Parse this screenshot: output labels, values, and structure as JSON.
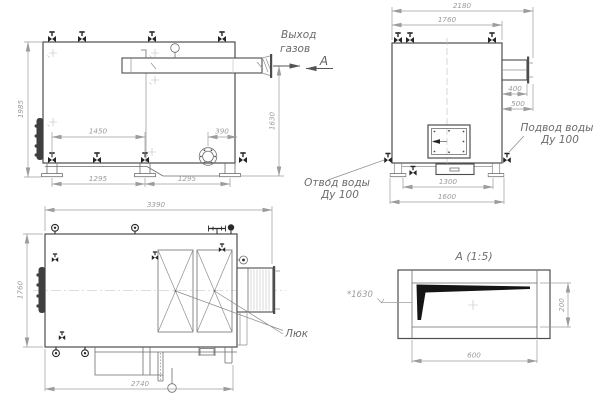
{
  "views": {
    "side": {
      "dims": {
        "h1985": "1985",
        "h1630": "1630",
        "w1450": "1450",
        "w390": "390",
        "w1295a": "1295",
        "w1295b": "1295"
      },
      "labels": {
        "gas1": "Выход",
        "gas2": "газов",
        "section": "А"
      }
    },
    "end": {
      "dims": {
        "w2180": "2180",
        "w1760": "1760",
        "w400": "400",
        "w500": "500",
        "w1300": "1300",
        "w1600": "1600"
      },
      "labels": {
        "supply1": "Подвод воды",
        "supply2": "Ду 100",
        "return1": "Отвод воды",
        "return2": "Ду 100"
      }
    },
    "plan": {
      "dims": {
        "l3390": "3390",
        "w1760": "1760",
        "l2740": "2740"
      },
      "labels": {
        "hatch": "Люк"
      }
    },
    "detail": {
      "title": "А (1:5)",
      "dims": {
        "w600": "600",
        "h200": "200",
        "note": "*1630"
      }
    }
  },
  "colors": {
    "outline": "#4d4d4d",
    "dimension": "#9c9c9c",
    "label": "#6a6a6a",
    "fitting": "#242424"
  }
}
